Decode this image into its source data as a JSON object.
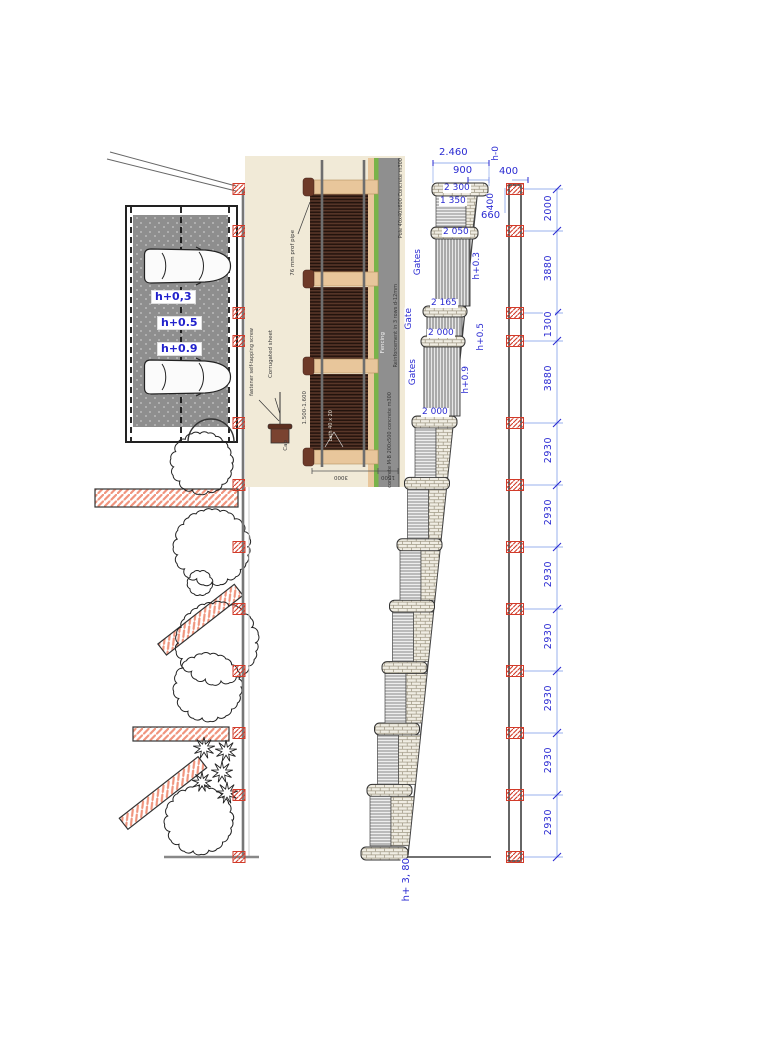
{
  "site_plan": {
    "height_labels": [
      "h+0,3",
      "h+0.5",
      "h+0.9"
    ]
  },
  "detail": {
    "pipe_label": "76 mm prof pipe",
    "pole_label": "Pole 40x40x600 Concrete m300",
    "reinforcement_label": "Reinforcement in 3 rows d-12mm",
    "fencing_label": "Fencing",
    "concrete_label": "concrete M-B 200x500 concrete m300",
    "fastener_label": "fastener self-tapping screw",
    "sheet_label": "Corrugated sheet",
    "cap_label": "Cap",
    "height_range": "1.500-1.600",
    "lath_label": "Lath 40 x 20",
    "width_dim": "3000",
    "depth_dim": "1500"
  },
  "elevation": {
    "dim_total": "2.460",
    "dim_900": "900",
    "dim_400_top": "400",
    "dim_400_side": "400",
    "dim_660": "660",
    "panel_dims": [
      "2 300",
      "1 350",
      "2 050",
      "2 165",
      "2 000",
      "2 000"
    ],
    "section_labels": [
      "Gates",
      "Gate",
      "Gates"
    ],
    "level_labels": [
      "h-0",
      "h+0.3",
      "h+0.5",
      "h+0.9",
      "h+ 3, 80"
    ]
  },
  "dim_chain": {
    "segments": [
      "2000",
      "3880",
      "1300",
      "3880",
      "2930",
      "2930",
      "2930",
      "2930",
      "2930",
      "2930",
      "2930"
    ]
  },
  "colors": {
    "dim_text": "#2a2ad2",
    "dim_line": "#9ab2ee",
    "post_red": "#d23b2a",
    "wall_hatch": "#f0957e",
    "parking_gray": "#8e8e8e",
    "detail_bg": "#f1ead7",
    "panel_brown": "#46291e",
    "post_tan": "#e8c69b",
    "grass_green": "#79b34a",
    "foundation_gray": "#8f8f8f"
  }
}
